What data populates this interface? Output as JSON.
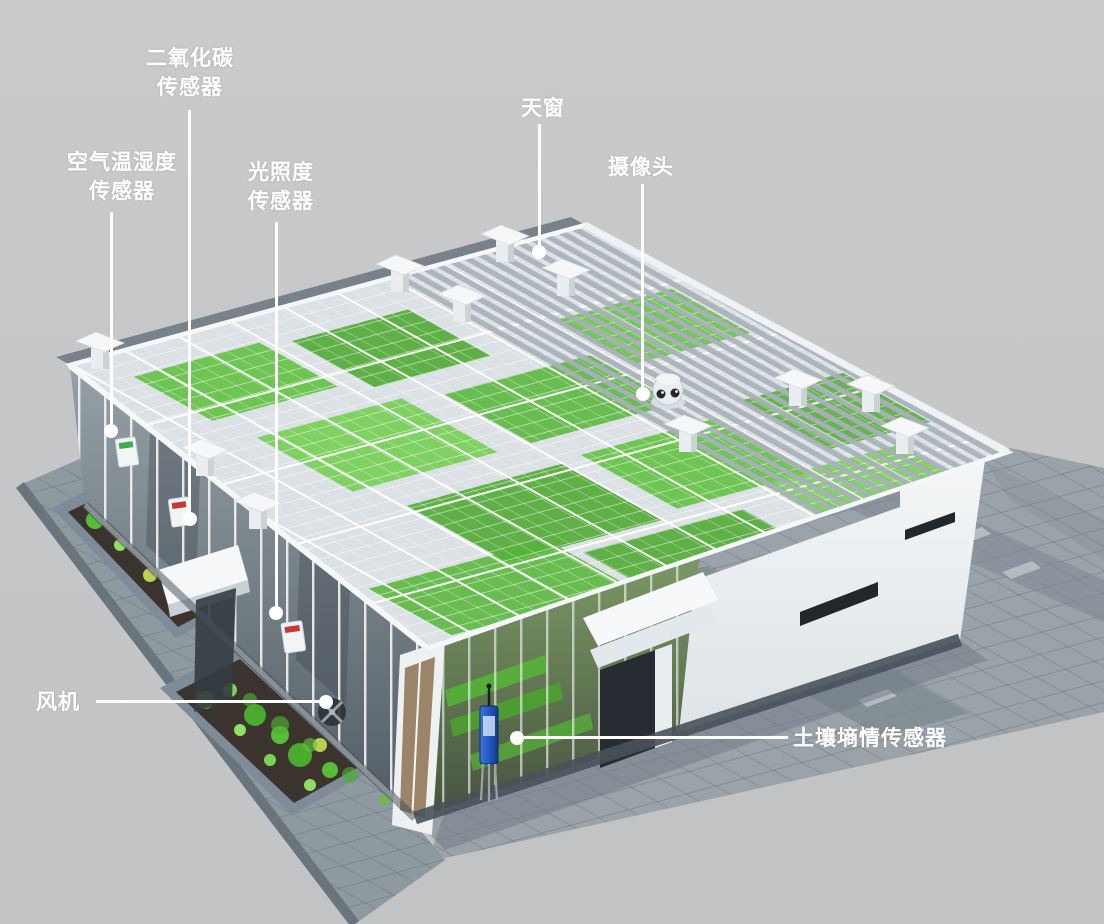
{
  "illustration": {
    "kind": "3d-greenhouse-sensor-layout",
    "background_color": "#c5c6c8"
  },
  "annotations": [
    {
      "id": "co2-sensor",
      "label": "二氧化碳\n传感器",
      "target": "co2-sensor-box"
    },
    {
      "id": "air-temp-humidity",
      "label": "空气温湿度\n传感器",
      "target": "air-sensor-box"
    },
    {
      "id": "light-sensor",
      "label": "光照度\n传感器",
      "target": "light-sensor-box"
    },
    {
      "id": "skylight",
      "label": "天窗",
      "target": "roof-vent"
    },
    {
      "id": "camera",
      "label": "摄像头",
      "target": "dome-camera"
    },
    {
      "id": "fan",
      "label": "风机",
      "target": "exhaust-fan"
    },
    {
      "id": "soil-moisture-sensor",
      "label": "土壤墒情传感器",
      "target": "soil-moisture-probe"
    }
  ],
  "devices": [
    {
      "name": "dome-camera"
    },
    {
      "name": "roof-vent",
      "count": 11
    },
    {
      "name": "soil-moisture-probe",
      "body_color": "#2458c4"
    },
    {
      "name": "exhaust-fan"
    },
    {
      "name": "air-sensor-box",
      "stripe_color": "#3fae4e"
    },
    {
      "name": "co2-sensor-box",
      "stripe_color": "#c43a35"
    },
    {
      "name": "light-sensor-box",
      "stripe_color": "#c43a35"
    }
  ],
  "colors": {
    "annotation_text": "#ffffff",
    "leader_line": "#ffffff",
    "leader_dot": "#ffffff",
    "structure_white": "#f4f7f8",
    "roof_glass": "#dbe1e4",
    "louver_gray": "#a9b1b8",
    "crop_green": "#55b636",
    "paving": "#9aa3aa",
    "paving_dark_band": "#7f8991",
    "planter_stone": "#7d8c96",
    "planter_soil": "#3b342e",
    "wall_white": "#eef1f3",
    "window_slot": "#22272b",
    "probe_blue": "#2458c4"
  }
}
